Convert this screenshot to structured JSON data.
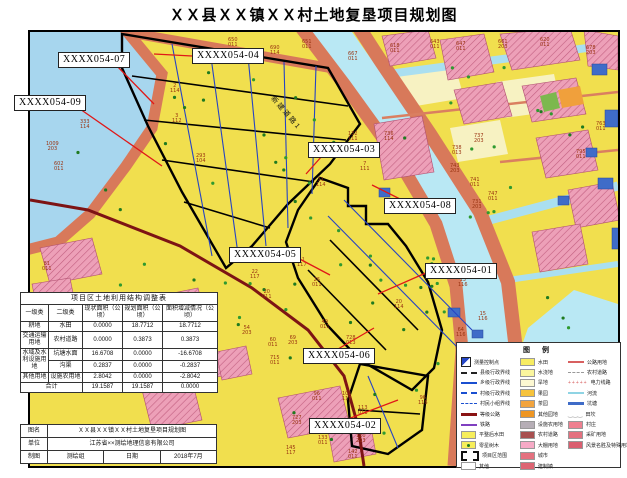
{
  "title": "ＸＸ县ＸＸ镇ＸＸ村土地复垦项目规划图",
  "map": {
    "road_label": "新建道路1",
    "callouts": [
      {
        "label": "XXXX054-07",
        "bx": 28,
        "by": 20,
        "x1": 86,
        "y1": 33,
        "x2": 124,
        "y2": 72
      },
      {
        "label": "XXXX054-04",
        "bx": 162,
        "by": 16,
        "x1": 162,
        "y1": 24,
        "x2": 124,
        "y2": 22
      },
      {
        "label": "XXXX054-09",
        "bx": -16,
        "by": 63,
        "x1": 50,
        "y1": 77,
        "x2": 132,
        "y2": 134
      },
      {
        "label": "XXXX054-03",
        "bx": 278,
        "by": 110,
        "x1": 292,
        "y1": 124,
        "x2": 276,
        "y2": 142
      },
      {
        "label": "XXXX054-08",
        "bx": 354,
        "by": 166,
        "x1": 370,
        "y1": 167,
        "x2": 342,
        "y2": 153
      },
      {
        "label": "XXXX054-05",
        "bx": 199,
        "by": 215,
        "x1": 264,
        "y1": 224,
        "x2": 300,
        "y2": 243
      },
      {
        "label": "XXXX054-01",
        "bx": 395,
        "by": 231,
        "x1": 398,
        "y1": 240,
        "x2": 348,
        "y2": 262
      },
      {
        "label": "XXXX054-06",
        "bx": 273,
        "by": 316,
        "x1": 308,
        "y1": 317,
        "x2": 344,
        "y2": 296
      },
      {
        "label": "XXXX054-02",
        "bx": 279,
        "by": 386,
        "x1": 318,
        "y1": 387,
        "x2": 368,
        "y2": 368
      }
    ],
    "parcel_numbers": [
      {
        "n": "650",
        "c": "011",
        "x": 198,
        "y": 6
      },
      {
        "n": "690",
        "c": "114",
        "x": 240,
        "y": 14
      },
      {
        "n": "651",
        "c": "011",
        "x": 272,
        "y": 8
      },
      {
        "n": "667",
        "c": "011",
        "x": 318,
        "y": 20
      },
      {
        "n": "618",
        "c": "011",
        "x": 360,
        "y": 12
      },
      {
        "n": "643",
        "c": "011",
        "x": 400,
        "y": 8
      },
      {
        "n": "647",
        "c": "011",
        "x": 426,
        "y": 10
      },
      {
        "n": "661",
        "c": "203",
        "x": 468,
        "y": 8
      },
      {
        "n": "620",
        "c": "011",
        "x": 510,
        "y": 6
      },
      {
        "n": "678",
        "c": "203",
        "x": 556,
        "y": 14
      },
      {
        "n": "333",
        "c": "114",
        "x": 50,
        "y": 88
      },
      {
        "n": "1009",
        "c": "203",
        "x": 16,
        "y": 110
      },
      {
        "n": "602",
        "c": "011",
        "x": 24,
        "y": 130
      },
      {
        "n": "293",
        "c": "104",
        "x": 166,
        "y": 122
      },
      {
        "n": "2",
        "c": "114",
        "x": 140,
        "y": 52
      },
      {
        "n": "3",
        "c": "112",
        "x": 142,
        "y": 82
      },
      {
        "n": "132",
        "c": "111",
        "x": 318,
        "y": 100
      },
      {
        "n": "7",
        "c": "111",
        "x": 330,
        "y": 130
      },
      {
        "n": "11",
        "c": "114",
        "x": 286,
        "y": 146
      },
      {
        "n": "736",
        "c": "114",
        "x": 354,
        "y": 100
      },
      {
        "n": "737",
        "c": "203",
        "x": 444,
        "y": 102
      },
      {
        "n": "738",
        "c": "013",
        "x": 422,
        "y": 114
      },
      {
        "n": "743",
        "c": "203",
        "x": 420,
        "y": 132
      },
      {
        "n": "741",
        "c": "011",
        "x": 440,
        "y": 146
      },
      {
        "n": "740",
        "c": "114",
        "x": 408,
        "y": 168
      },
      {
        "n": "747",
        "c": "011",
        "x": 458,
        "y": 160
      },
      {
        "n": "731",
        "c": "203",
        "x": 442,
        "y": 168
      },
      {
        "n": "763",
        "c": "011",
        "x": 566,
        "y": 90
      },
      {
        "n": "795",
        "c": "011",
        "x": 546,
        "y": 118
      },
      {
        "n": "41",
        "c": "117",
        "x": 267,
        "y": 226
      },
      {
        "n": "22",
        "c": "117",
        "x": 220,
        "y": 238
      },
      {
        "n": "26",
        "c": "011",
        "x": 282,
        "y": 246
      },
      {
        "n": "20",
        "c": "011",
        "x": 232,
        "y": 258
      },
      {
        "n": "20",
        "c": "114",
        "x": 364,
        "y": 268
      },
      {
        "n": "49",
        "c": "011",
        "x": 290,
        "y": 288
      },
      {
        "n": "54",
        "c": "203",
        "x": 212,
        "y": 294
      },
      {
        "n": "60",
        "c": "011",
        "x": 238,
        "y": 306
      },
      {
        "n": "69",
        "c": "203",
        "x": 258,
        "y": 304
      },
      {
        "n": "715",
        "c": "011",
        "x": 240,
        "y": 324
      },
      {
        "n": "728",
        "c": "013",
        "x": 316,
        "y": 304
      },
      {
        "n": "13",
        "c": "116",
        "x": 428,
        "y": 246
      },
      {
        "n": "15",
        "c": "116",
        "x": 448,
        "y": 280
      },
      {
        "n": "64",
        "c": "116",
        "x": 426,
        "y": 296
      },
      {
        "n": "96",
        "c": "011",
        "x": 282,
        "y": 360
      },
      {
        "n": "101",
        "c": "117",
        "x": 312,
        "y": 360
      },
      {
        "n": "113",
        "c": "011",
        "x": 328,
        "y": 374
      },
      {
        "n": "727",
        "c": "203",
        "x": 262,
        "y": 384
      },
      {
        "n": "133",
        "c": "011",
        "x": 288,
        "y": 404
      },
      {
        "n": "120",
        "c": "203",
        "x": 326,
        "y": 402
      },
      {
        "n": "145",
        "c": "117",
        "x": 256,
        "y": 414
      },
      {
        "n": "142",
        "c": "011",
        "x": 318,
        "y": 418
      },
      {
        "n": "96",
        "c": "116",
        "x": 388,
        "y": 364
      },
      {
        "n": "130",
        "c": "011",
        "x": 142,
        "y": 406
      },
      {
        "n": "81",
        "c": "011",
        "x": 12,
        "y": 230
      }
    ]
  },
  "adjustment_table": {
    "title": "项目区土地利用结构调整表",
    "headers": [
      "一级类",
      "二级类",
      "现状面积（公顷）",
      "规划面积（公顷）",
      "面积增减情况（公顷）"
    ],
    "rows": [
      {
        "l1": "耕地",
        "l2": "水田",
        "now": "0.0000",
        "plan": "18.7712",
        "delta": "18.7712"
      },
      {
        "l1": "交通运输用地",
        "l2": "农村道路",
        "now": "0.0000",
        "plan": "0.3873",
        "delta": "0.3873"
      },
      {
        "l1": "水域及水利设施用地",
        "l2": "坑塘水面",
        "now": "16.6708",
        "plan": "0.0000",
        "delta": "-16.6708"
      },
      {
        "l1": "",
        "l2": "沟渠",
        "now": "0.2837",
        "plan": "0.0000",
        "delta": "-0.2837"
      },
      {
        "l1": "其他用地",
        "l2": "设施农用地",
        "now": "2.8042",
        "plan": "0.0000",
        "delta": "-2.8042"
      }
    ],
    "total": {
      "label": "合计",
      "now": "19.1587",
      "plan": "19.1587",
      "delta": "0.0000"
    }
  },
  "info_table": {
    "name_label": "图名",
    "name_value": "ＸＸ县ＸＸ镇ＸＸ村土地复垦项目规划图",
    "unit_label": "单位",
    "unit_value": "江苏省××测绘地理信息有限公司",
    "draw_label": "制图",
    "draw_value": "测绘组",
    "date_label": "日期",
    "date_value": "2018年7月"
  },
  "legend": {
    "title": "图 例",
    "col1": [
      {
        "t": "bench",
        "label": "测量控制点"
      },
      {
        "t": "line",
        "c": "#222222",
        "s": "dashed",
        "w": 2,
        "label": "县级行政界线"
      },
      {
        "t": "line",
        "c": "#1a4fd0",
        "s": "solid",
        "w": 2,
        "label": "乡级行政界线"
      },
      {
        "t": "line",
        "c": "#1a4fd0",
        "s": "dashed",
        "w": 2,
        "label": "村级行政界线"
      },
      {
        "t": "line",
        "c": "#1a4fd0",
        "s": "dashed",
        "w": 1,
        "label": "村民小组界线"
      },
      {
        "t": "line",
        "c": "#8a1313",
        "s": "solid",
        "w": 3,
        "label": "等级公路"
      },
      {
        "t": "line",
        "c": "#8040c0",
        "s": "solid",
        "w": 2,
        "label": "铁路"
      },
      {
        "t": "swatch",
        "c": "#f7ee5a",
        "label": "平整后水田"
      },
      {
        "t": "swatchdot",
        "c": "#f7ee5a",
        "label": "零星树木"
      },
      {
        "t": "proj",
        "label": "项目区范围"
      },
      {
        "t": "swatch",
        "c": "#ffffff",
        "label": "其他"
      }
    ],
    "col2": [
      {
        "t": "swatch",
        "c": "#f7ec62",
        "label": "水田"
      },
      {
        "t": "swatch",
        "c": "#faf59e",
        "label": "水浇地"
      },
      {
        "t": "swatch",
        "c": "#fdf8d2",
        "label": "旱地"
      },
      {
        "t": "swatch",
        "c": "#f6c33c",
        "label": "果园"
      },
      {
        "t": "swatch",
        "c": "#f2a43e",
        "label": "茶园"
      },
      {
        "t": "swatch",
        "c": "#ee9624",
        "label": "其他园地"
      },
      {
        "t": "swatch",
        "c": "#b6aeb6",
        "label": "设施农用地"
      },
      {
        "t": "swatch",
        "c": "#a85050",
        "label": "农村道路"
      },
      {
        "t": "swatch",
        "c": "#f6aac6",
        "label": "大棚用地"
      },
      {
        "t": "swatch",
        "c": "#e4717f",
        "label": "城市"
      },
      {
        "t": "swatch",
        "c": "#dd6573",
        "label": "建制镇"
      }
    ],
    "col3": [
      {
        "t": "line",
        "c": "#d86060",
        "s": "solid",
        "w": 2,
        "label": "公路用地"
      },
      {
        "t": "line",
        "c": "#999999",
        "s": "dashed",
        "w": 1,
        "label": "农村道路"
      },
      {
        "t": "plus",
        "c": "#d86060",
        "label": "电力线路"
      },
      {
        "t": "line",
        "c": "#8fd4e4",
        "s": "solid",
        "w": 2,
        "label": "河流"
      },
      {
        "t": "line",
        "c": "#3f6cc8",
        "s": "solid",
        "w": 3,
        "label": "坑塘"
      },
      {
        "t": "zigzag",
        "c": "#999999",
        "label": "田坎"
      },
      {
        "t": "swatch",
        "c": "#ee8090",
        "label": "村庄"
      },
      {
        "t": "swatch",
        "c": "#e4717f",
        "label": "采矿用地"
      },
      {
        "t": "swatch",
        "c": "#da5f70",
        "label": "风景名胜及特殊用地"
      }
    ]
  }
}
